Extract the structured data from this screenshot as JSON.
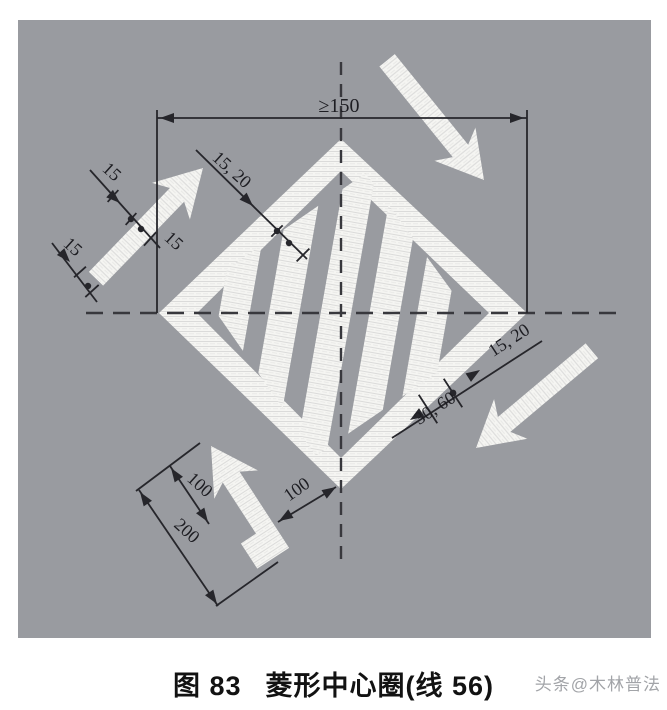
{
  "panel": {
    "road_color": "#999ba0",
    "marking_color": "#f5f5f2",
    "line_color": "#26262b"
  },
  "dimensions": {
    "top_width": "≥150",
    "upper_left_stripe": "15, 20",
    "left_width_1": "15",
    "left_width_2": "15",
    "left_width_3": "15",
    "lower_right_stripe": "15, 20",
    "lower_right_spacing": "30, 60",
    "arrow_width": "100",
    "arrow_length": "200",
    "vertex_gap": "100"
  },
  "caption": {
    "figure_label": "图 83",
    "title": "菱形中心圈(线 56)"
  },
  "watermark": {
    "text": "头条@木林普法"
  }
}
